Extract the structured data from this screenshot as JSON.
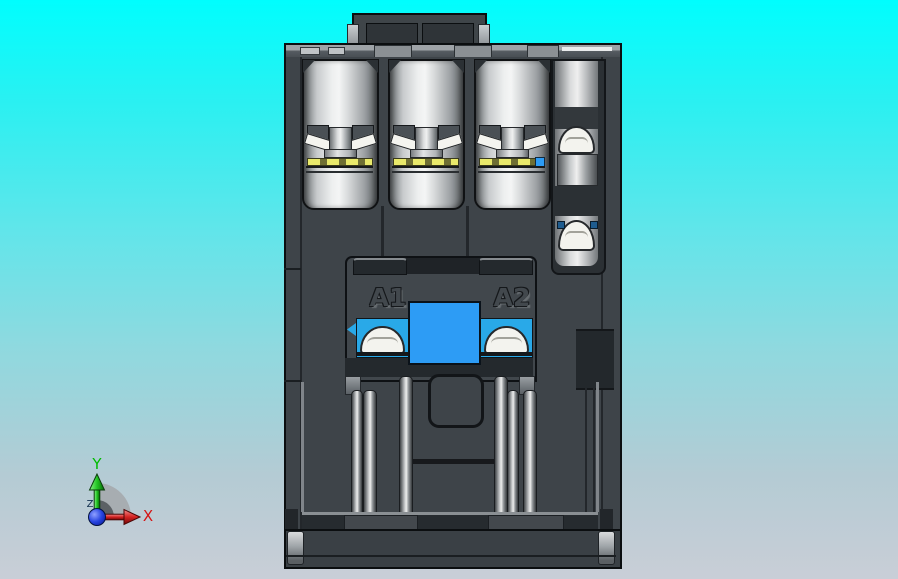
{
  "viewport": {
    "background": {
      "top_color": "#00FEFE",
      "bottom_color": "#C9CED7"
    }
  },
  "model": {
    "labels": {
      "coil_a1": "A1",
      "coil_a2": "A2"
    },
    "colors": {
      "housing_gray": "#3E4449",
      "housing_deep_gray": "#24292D",
      "metal_silver": "#EDEFEF",
      "clamp_white": "#F3F3EE",
      "accent_blue_square": "#2D9CF5",
      "coil_terminal_blue": "#29A9E8",
      "contact_yellow": "#E9E96B"
    }
  },
  "axis_triad": {
    "x": {
      "label": "X",
      "color": "#D51515"
    },
    "y": {
      "label": "Y",
      "color": "#00BB00"
    },
    "z": {
      "label": "Z",
      "color": "#12304F"
    },
    "origin_color": "#1133CC"
  }
}
